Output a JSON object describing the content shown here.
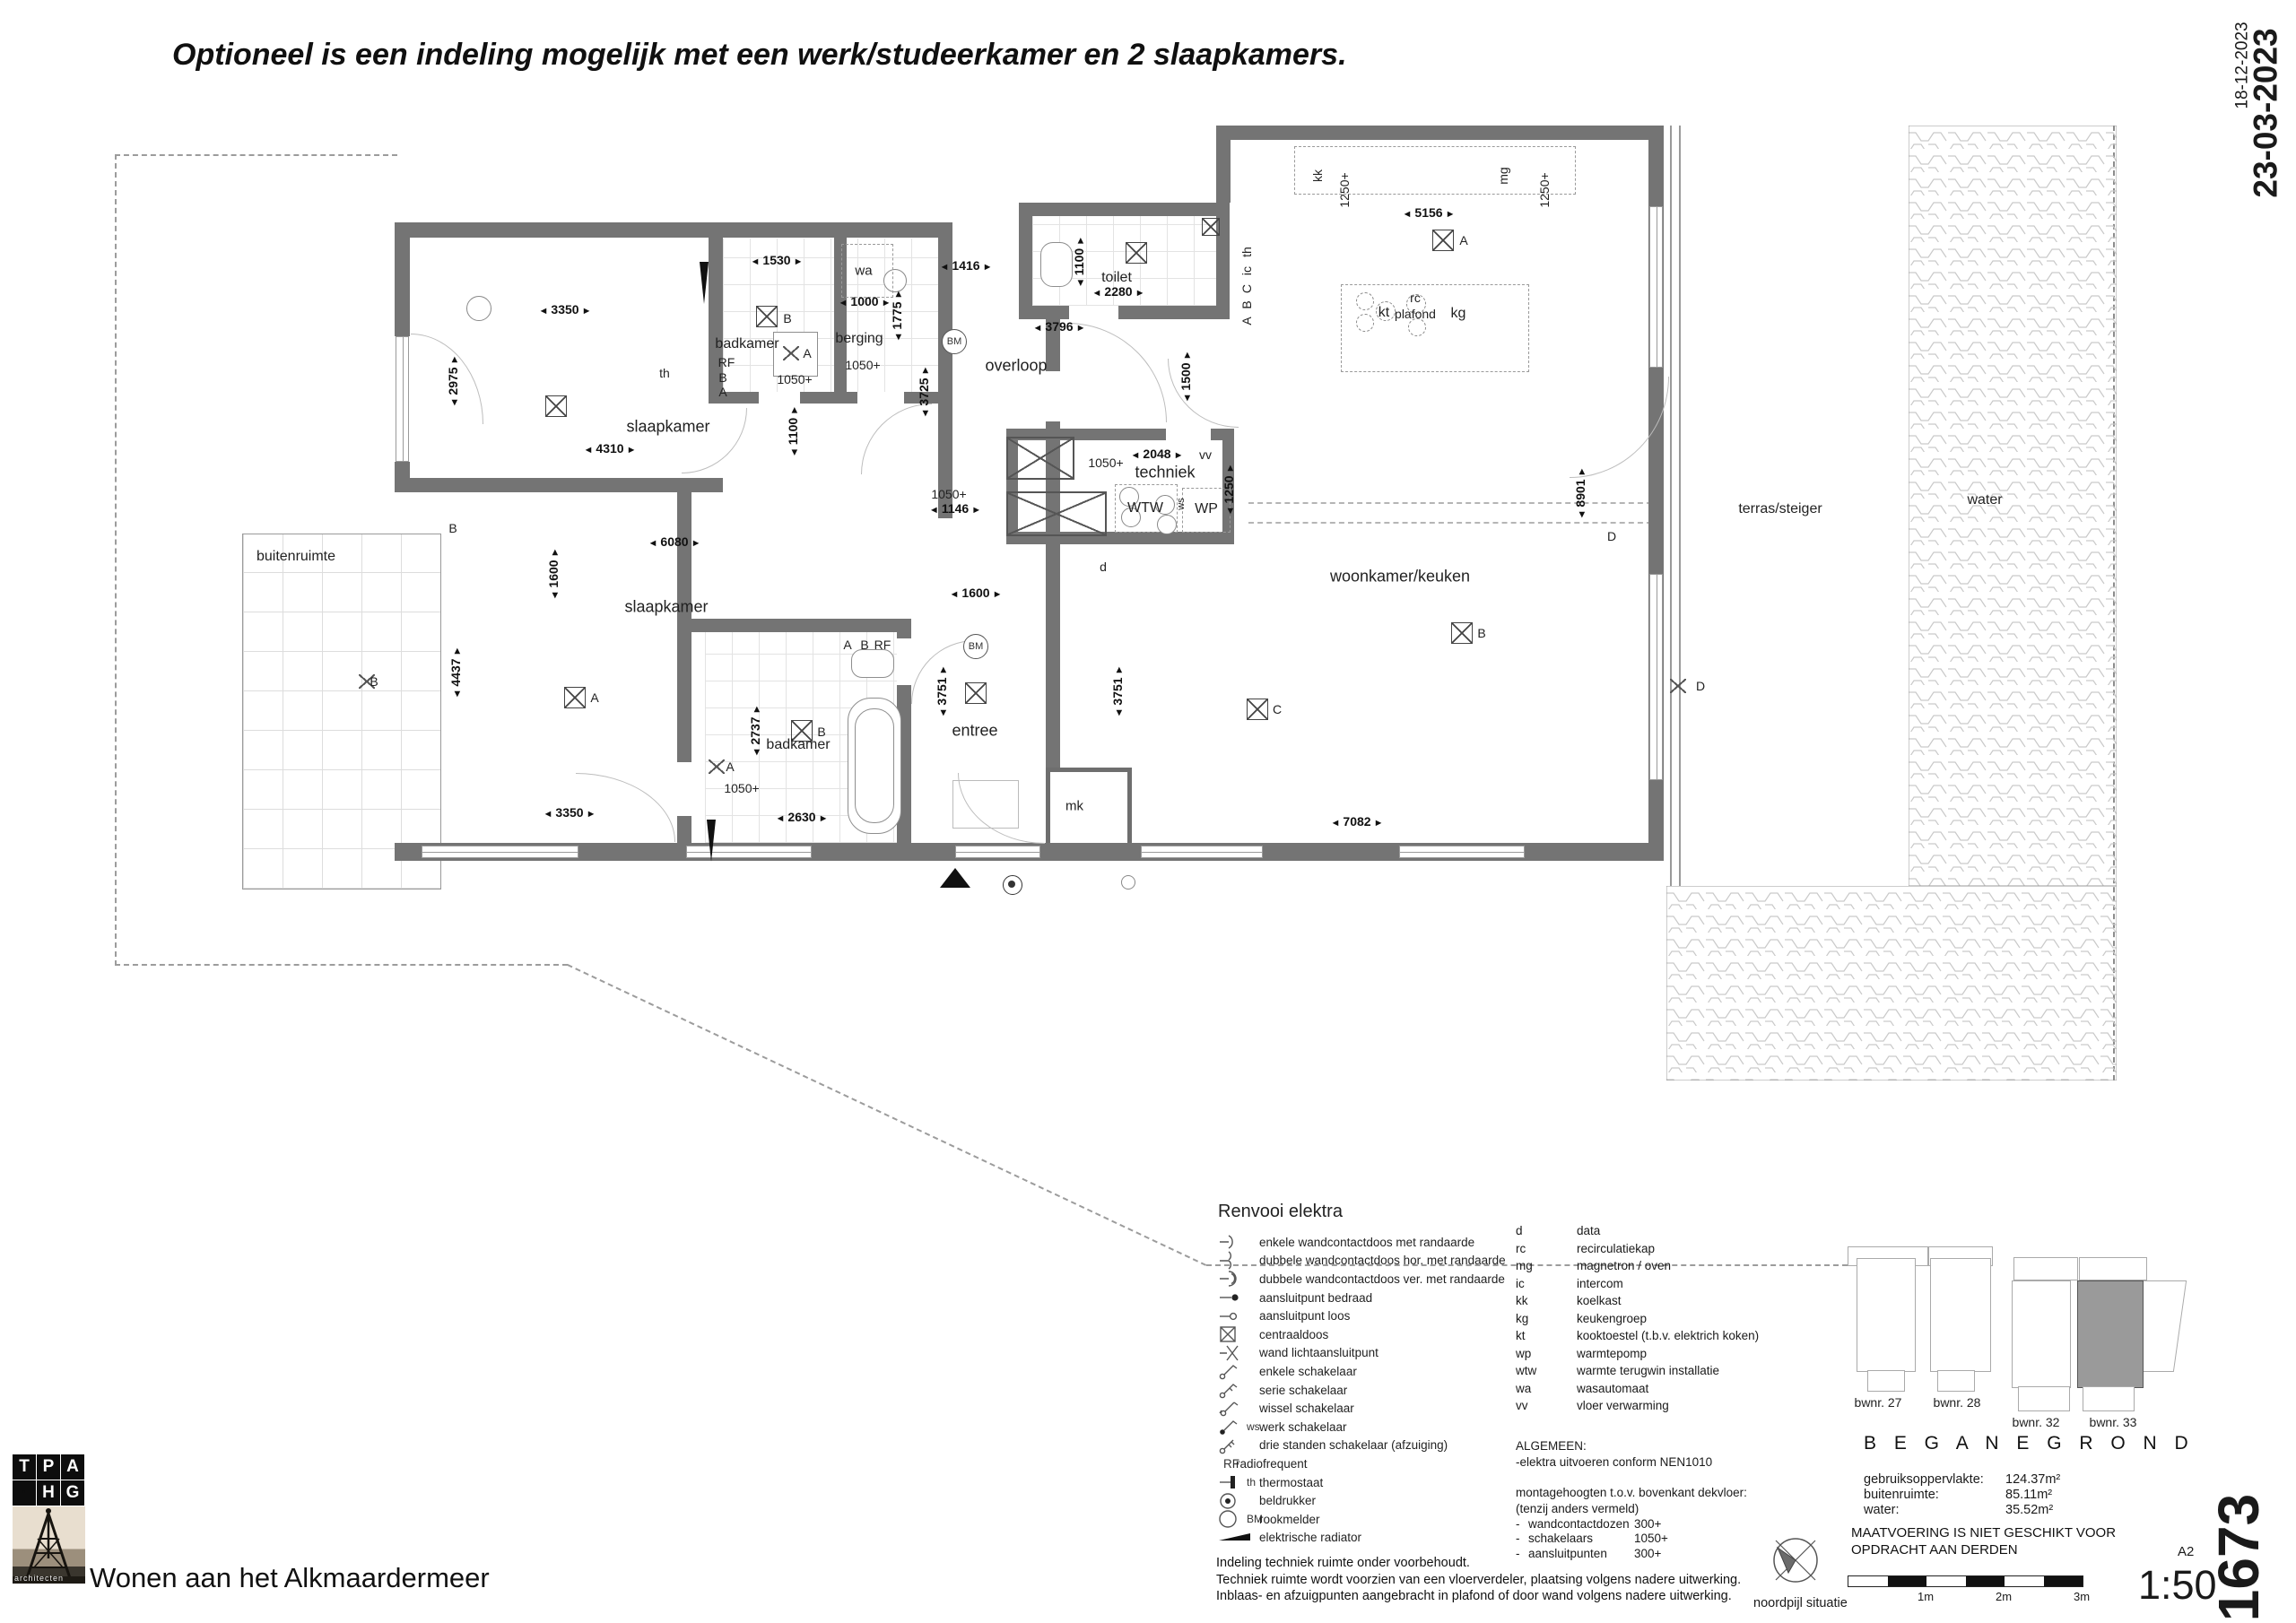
{
  "title": "Optioneel is een indeling mogelijk met een werk/studeerkamer en 2 slaapkamers.",
  "margin": {
    "date_small": "18-12-2023",
    "date_large": "23-03-2023",
    "block_label": "Blok B2 - bouwnummer - 33B",
    "project_number": "1673",
    "paper_size": "A2",
    "scale": "1:50"
  },
  "footer": {
    "logo_tiles": [
      "T",
      "P",
      "A",
      "H",
      "G"
    ],
    "logo_caption": "architecten",
    "project_name": "Wonen aan het Alkmaardermeer"
  },
  "legend": {
    "title": "Renvooi elektra",
    "items": [
      {
        "icon": "socket-single-icon",
        "code": "",
        "label": "enkele wandcontactdoos met randaarde"
      },
      {
        "icon": "socket-double-h-icon",
        "code": "",
        "label": "dubbele wandcontactdoos hor. met randaarde"
      },
      {
        "icon": "socket-double-v-icon",
        "code": "",
        "label": "dubbele wandcontactdoos ver. met randaarde"
      },
      {
        "icon": "point-wired-icon",
        "code": "",
        "label": "aansluitpunt bedraad"
      },
      {
        "icon": "point-empty-icon",
        "code": "",
        "label": "aansluitpunt loos"
      },
      {
        "icon": "centraaldoos-icon",
        "code": "",
        "label": "centraaldoos"
      },
      {
        "icon": "wall-light-icon",
        "code": "",
        "label": "wand lichtaansluitpunt"
      },
      {
        "icon": "switch-single-icon",
        "code": "",
        "label": "enkele schakelaar"
      },
      {
        "icon": "switch-series-icon",
        "code": "",
        "label": "serie schakelaar"
      },
      {
        "icon": "switch-change-icon",
        "code": "",
        "label": "wissel schakelaar"
      },
      {
        "icon": "switch-work-icon",
        "code": "ws",
        "label": "werk schakelaar"
      },
      {
        "icon": "switch-3pos-icon",
        "code": "",
        "label": "drie standen schakelaar (afzuiging)"
      },
      {
        "icon": "rf-icon",
        "code": "RF",
        "label": "radiofrequent"
      },
      {
        "icon": "thermostat-icon",
        "code": "th",
        "label": "thermostaat"
      },
      {
        "icon": "bell-icon",
        "code": "",
        "label": "beldrukker"
      },
      {
        "icon": "smoke-icon",
        "code": "BM",
        "label": "rookmelder"
      },
      {
        "icon": "radiator-icon",
        "code": "",
        "label": "elektrische radiator"
      }
    ],
    "abbreviations": [
      {
        "code": "d",
        "meaning": "data"
      },
      {
        "code": "rc",
        "meaning": "recirculatiekap"
      },
      {
        "code": "mg",
        "meaning": "magnetron / oven"
      },
      {
        "code": "ic",
        "meaning": "intercom"
      },
      {
        "code": "kk",
        "meaning": "koelkast"
      },
      {
        "code": "kg",
        "meaning": "keukengroep"
      },
      {
        "code": "kt",
        "meaning": "kooktoestel (t.b.v. elektrich koken)"
      },
      {
        "code": "wp",
        "meaning": "warmtepomp"
      },
      {
        "code": "wtw",
        "meaning": "warmte terugwin installatie"
      },
      {
        "code": "wa",
        "meaning": "wasautomaat"
      },
      {
        "code": "vv",
        "meaning": "vloer verwarming"
      }
    ]
  },
  "general": {
    "heading": "ALGEMEEN:",
    "line1": "-elektra uitvoeren conform NEN1010",
    "line2": "montagehoogten t.o.v. bovenkant dekvloer:",
    "line3": "(tenzij anders vermeld)",
    "heights": [
      {
        "label": "wandcontactdozen",
        "value": "300+"
      },
      {
        "label": "schakelaars",
        "value": "1050+"
      },
      {
        "label": "aansluitpunten",
        "value": "300+"
      }
    ]
  },
  "notes": [
    "Indeling techniek ruimte onder voorbehoudt.",
    "Techniek ruimte wordt voorzien van een vloerverdeler, plaatsing volgens nadere uitwerking.",
    "Inblaas- en afzuigpunten aangebracht in plafond of door wand volgens nadere uitwerking."
  ],
  "situatie": {
    "bwnr_labels": [
      "bwnr. 27",
      "bwnr. 28",
      "bwnr. 32",
      "bwnr. 33"
    ],
    "floor_title": "B E G A N E  G R O N D",
    "areas": [
      {
        "label": "gebruiksoppervlakte:",
        "value": "124.37m²"
      },
      {
        "label": "buitenruimte:",
        "value": "85.11m²"
      },
      {
        "label": "water:",
        "value": "35.52m²"
      }
    ],
    "disclaimer_line1": "MAATVOERING IS NIET GESCHIKT VOOR",
    "disclaimer_line2": "OPDRACHT AAN DERDEN",
    "scalebar_labels": [
      "1m",
      "2m",
      "3m"
    ],
    "north_label": "noordpijl situatie"
  },
  "plan": {
    "rooms": {
      "slaapkamer1": "slaapkamer",
      "badkamer1": "badkamer",
      "berging": "berging",
      "wa": "wa",
      "toilet": "toilet",
      "overloop": "overloop",
      "techniek": "techniek",
      "woonkamer": "woonkamer/keuken",
      "slaapkamer2": "slaapkamer",
      "badkamer2": "badkamer",
      "entree": "entree",
      "mk": "mk",
      "buitenruimte": "buitenruimte",
      "terras": "terras/steiger",
      "water": "water"
    },
    "dims": {
      "d1": "3350",
      "d2": "2975",
      "d3": "4310",
      "d4": "1530",
      "d5": "1000",
      "d6": "1775",
      "d7": "1416",
      "d8": "1100",
      "d9": "2280",
      "d10": "3796",
      "d11": "3725",
      "d12": "1500",
      "d13": "1146",
      "d14": "2048",
      "d15": "1250",
      "d16": "5156",
      "d17": "8901",
      "d18": "7082",
      "d19": "6080",
      "d20": "4437",
      "d21": "3350",
      "d22": "2737",
      "d23": "2630",
      "d24": "1600",
      "d25": "3751",
      "d26": "3751",
      "d27": "1600",
      "d28": "1100"
    },
    "codes": {
      "h1": "1050+",
      "h2": "1050+",
      "h3": "1050+",
      "h4": "1050+",
      "h5": "1050+",
      "kk": "kk",
      "p1250a": "1250+",
      "mg": "mg",
      "p1250b": "1250+",
      "kt": "kt",
      "rc1": "rc",
      "rc2": "plafond",
      "kg": "kg",
      "wtw": "WTW",
      "wp": "WP",
      "ws": "ws",
      "vv": "vv",
      "d": "d",
      "th1": "th",
      "rf1": "RF",
      "b1": "B",
      "a1": "A",
      "b2": "B",
      "a2": "A",
      "th2": "th",
      "ic": "ic",
      "c1": "C",
      "b3": "B",
      "a3": "A",
      "d1": "D",
      "d2": "D",
      "bwk": "B",
      "cwk": "C",
      "akk": "A",
      "ask": "A",
      "bbk": "B",
      "bwl": "B",
      "bdr": "B",
      "a4": "A",
      "b5": "B",
      "rf2": "RF",
      "a5": "A",
      "bm1": "BM",
      "bm2": "BM"
    }
  }
}
